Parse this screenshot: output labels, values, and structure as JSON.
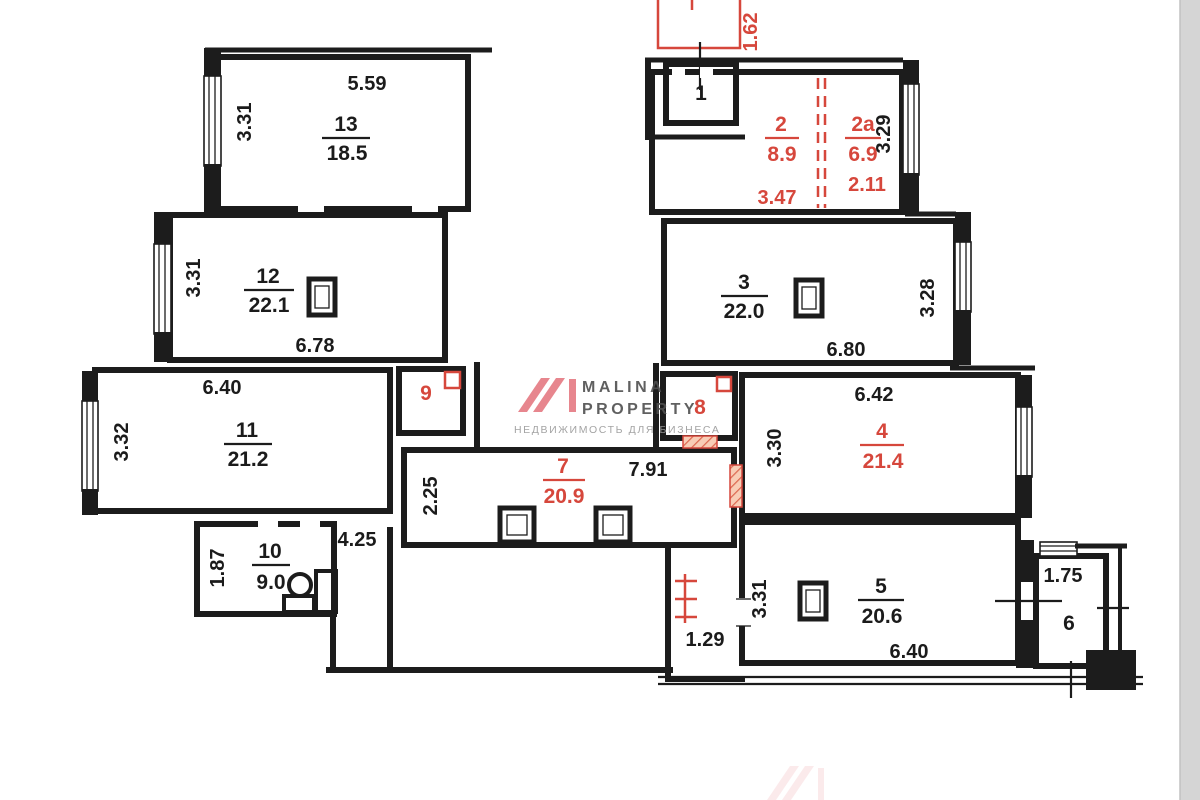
{
  "watermark": {
    "brand_line1": "MALINA",
    "brand_line2": "PROPERTY",
    "tagline": "НЕДВИЖИМОСТЬ ДЛЯ БИЗНЕСА"
  },
  "colors": {
    "background": "#ffffff",
    "wall": "#1c1c1c",
    "label": "#1b1b1b",
    "red": "#d6473c",
    "hatch_fill": "#f8cdb6",
    "hatch_line": "#dd6a52",
    "logo_pink": "#e57a82",
    "brand_gray": "#4f4f4f",
    "tagline_gray": "#9a9a9a",
    "edge_gray": "#d5d5d5"
  },
  "rooms": {
    "r13": {
      "number": "13",
      "area": "18.5",
      "width": "5.59",
      "height": "3.31"
    },
    "r12": {
      "number": "12",
      "area": "22.1",
      "width": "6.78",
      "height": "3.31"
    },
    "r11": {
      "number": "11",
      "area": "21.2",
      "width": "6.40",
      "height": "3.32"
    },
    "r10": {
      "number": "10",
      "area": "9.0",
      "height": "1.87"
    },
    "hall": {
      "width": "4.25"
    },
    "r9": {
      "number": "9"
    },
    "r8": {
      "number": "8"
    },
    "r7": {
      "number": "7",
      "area": "20.9",
      "height": "2.25",
      "width": "7.91"
    },
    "nook": {
      "width": "1.29"
    },
    "r1": {
      "number": "1"
    },
    "annex": {
      "height": "1.62"
    },
    "r2": {
      "number": "2",
      "area": "8.9",
      "width": "3.47"
    },
    "r2a": {
      "number": "2a",
      "area": "6.9",
      "width": "2.11",
      "height": "3.29"
    },
    "r3": {
      "number": "3",
      "area": "22.0",
      "width": "6.80",
      "height": "3.28"
    },
    "r4": {
      "number": "4",
      "area": "21.4",
      "width": "6.42",
      "height": "3.30"
    },
    "r5": {
      "number": "5",
      "area": "20.6",
      "width": "6.40",
      "height": "3.31"
    },
    "r6": {
      "number": "6",
      "width": "1.75"
    }
  }
}
